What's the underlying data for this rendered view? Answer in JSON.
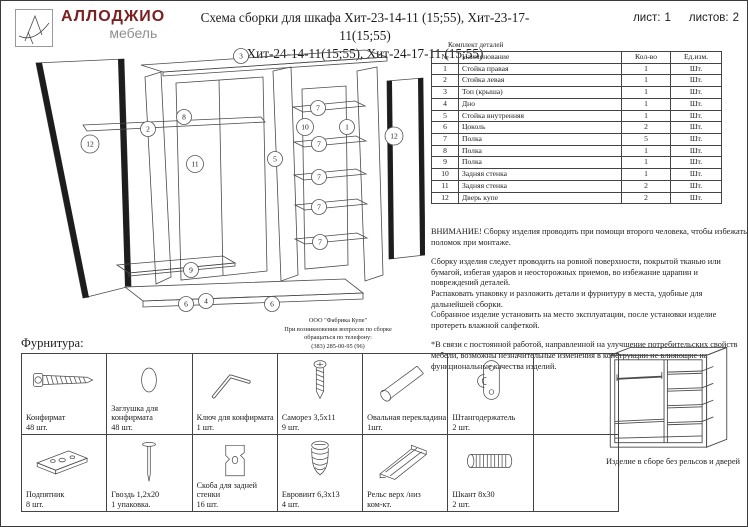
{
  "logo": {
    "brand": "АЛЛОДЖИО",
    "sub": "мебель",
    "brand_color": "#7b2022",
    "sub_color": "#8f8f8f",
    "mark": "stylized-a-logo"
  },
  "title": {
    "line1": "Схема сборки для шкафа Хит-23-14-11 (15;55), Хит-23-17-11(15;55)",
    "line2": "Хит-24-14-11(15;55), Хит-24-17-11 (15;55)"
  },
  "sheet": {
    "sheet_label": "лист:",
    "sheet_value": "1",
    "sheets_label": "листов:",
    "sheets_value": "2"
  },
  "parts_table": {
    "caption": "Комплект деталей",
    "headers": [
      "№",
      "Наименование",
      "Кол-во",
      "Ед.изм."
    ],
    "rows": [
      {
        "num": "1",
        "name": "Стойка правая",
        "qty": "1",
        "unit": "Шт."
      },
      {
        "num": "2",
        "name": "Стойка левая",
        "qty": "1",
        "unit": "Шт."
      },
      {
        "num": "3",
        "name": "Топ (крыша)",
        "qty": "1",
        "unit": "Шт."
      },
      {
        "num": "4",
        "name": "Дно",
        "qty": "1",
        "unit": "Шт."
      },
      {
        "num": "5",
        "name": "Стойка внутренняя",
        "qty": "1",
        "unit": "Шт."
      },
      {
        "num": "6",
        "name": "Цоколь",
        "qty": "2",
        "unit": "Шт."
      },
      {
        "num": "7",
        "name": "Полка",
        "qty": "5",
        "unit": "Шт."
      },
      {
        "num": "8",
        "name": "Полка",
        "qty": "1",
        "unit": "Шт."
      },
      {
        "num": "9",
        "name": "Полка",
        "qty": "1",
        "unit": "Шт."
      },
      {
        "num": "10",
        "name": "Задняя стенка",
        "qty": "1",
        "unit": "Шт."
      },
      {
        "num": "11",
        "name": "Задняя стенка",
        "qty": "2",
        "unit": "Шт."
      },
      {
        "num": "12",
        "name": "Дверь купе",
        "qty": "2",
        "unit": "Шт."
      }
    ]
  },
  "notices": {
    "warning": "ВНИМАНИЕ! Сборку изделия проводить при помощи второго человека, чтобы избежать поломок при монтаже.",
    "p1": "Сборку изделия следует проводить на ровной поверхности, покрытой тканью или бумагой, избегая ударов и неосторожных приемов, во избежание царапин и повреждений деталей.",
    "p2": "Распаковать упаковку и разложить детали и фурнитуру в места, удобные для дальнейшей сборки.",
    "p3": "Собранное изделие установить на место эксплуатации, после установки изделие протереть влажной салфеткой.",
    "p4": "*В связи с постоянной работой, направленной на улучшение потребительских свойств мебели, возможны незначительные изменения в конструкции не влияющие на функциональные качества изделий."
  },
  "factory": {
    "line1": "ООО \"Фабрика Купе\"",
    "line2": "При возникновении вопросов по сборке",
    "line3": "обращаться по телефону:",
    "line4": "(383) 285-00-95 (96)"
  },
  "diagram": {
    "callouts": [
      {
        "label": "3"
      },
      {
        "label": "12"
      },
      {
        "label": "2"
      },
      {
        "label": "8"
      },
      {
        "label": "11"
      },
      {
        "label": "9"
      },
      {
        "label": "5"
      },
      {
        "label": "10"
      },
      {
        "label": "1"
      },
      {
        "label": "12"
      },
      {
        "label": "7"
      },
      {
        "label": "7"
      },
      {
        "label": "7"
      },
      {
        "label": "7"
      },
      {
        "label": "7"
      },
      {
        "label": "6"
      },
      {
        "label": "4"
      },
      {
        "label": "6"
      }
    ]
  },
  "hardware": {
    "heading": "Фурнитура:",
    "items": [
      {
        "name": "Конфирмат",
        "qty": "48 шт.",
        "icon": "confirmat-screw-icon"
      },
      {
        "name": "Заглушка для конфирмата",
        "qty": "48 шт.",
        "icon": "cap-icon"
      },
      {
        "name": "Ключ для конфирмата",
        "qty": "1 шт.",
        "icon": "hex-key-icon"
      },
      {
        "name": "Саморез 3,5х11",
        "qty": "9 шт.",
        "icon": "screw-icon"
      },
      {
        "name": "Овальная перекладина",
        "qty": "1шт.",
        "icon": "oval-rail-icon"
      },
      {
        "name": "Штангодержатель",
        "qty": "2 шт.",
        "icon": "rail-holder-icon"
      },
      {
        "name": "Подпятник",
        "qty": "8 шт.",
        "icon": "foot-pad-icon"
      },
      {
        "name": "Гвоздь 1,2х20",
        "qty": "1 упаковка.",
        "icon": "nail-icon"
      },
      {
        "name": "Скоба для задней стенки",
        "qty": "16 шт.",
        "icon": "back-wall-bracket-icon"
      },
      {
        "name": "Евровинт 6,3х13",
        "qty": "4 шт.",
        "icon": "euro-screw-icon"
      },
      {
        "name": "Рельс верх /низ",
        "qty": "ком-кт.",
        "icon": "rail-profile-icon"
      },
      {
        "name": "Шкант 8х30",
        "qty": "2 шт.",
        "icon": "dowel-icon"
      }
    ]
  },
  "assembled": {
    "caption": "Изделие в сборе без рельсов и дверей"
  }
}
